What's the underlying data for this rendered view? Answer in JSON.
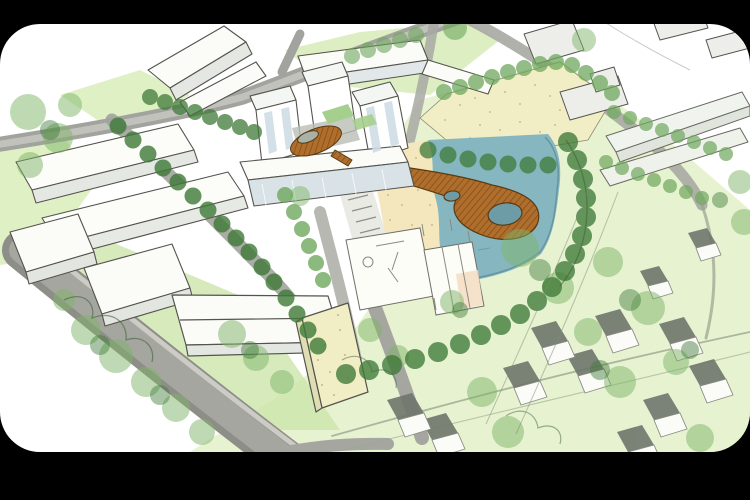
{
  "frame": {
    "background": "#000000",
    "canvas": "#ffffff",
    "corner_radius_px": 40
  },
  "scene": {
    "type": "site-masterplan-aerial-sketch",
    "features": [
      "pond",
      "beach",
      "looping-boardwalk-pier",
      "courtyard-loop-pavilion",
      "apartment-towers",
      "perimeter-blocks",
      "tree-lined-streets",
      "sports-courts-plaza",
      "sand-field",
      "detached-housing",
      "ring-road"
    ]
  },
  "colors": {
    "water": "#86b7c0",
    "water_deep": "#6d9ba6",
    "water_edge": "#5e8c96",
    "sand": "#f4e7bd",
    "sand_dot": "#c4ae74",
    "field": "#f1eec5",
    "grass_light": "#e6f2d0",
    "grass_mid": "#cde5ab",
    "grass_pale": "#ddeec3",
    "tree_dark": "#3f7a38",
    "tree_mid": "#6fa85e",
    "tree_soft": "#7fb569",
    "road": "#a2a29e",
    "road_light": "#c2c2bd",
    "road_dark": "#8e8e88",
    "boardwalk": "#b06e2c",
    "boardwalk_line": "#7c4a16",
    "building_white": "#fbfbf8",
    "building_shade": "#e4e7e2",
    "glass": "#cfdde6",
    "outline": "#54544e",
    "house_shadow": "#6f766d",
    "court_accent": "#f5dcc3"
  }
}
